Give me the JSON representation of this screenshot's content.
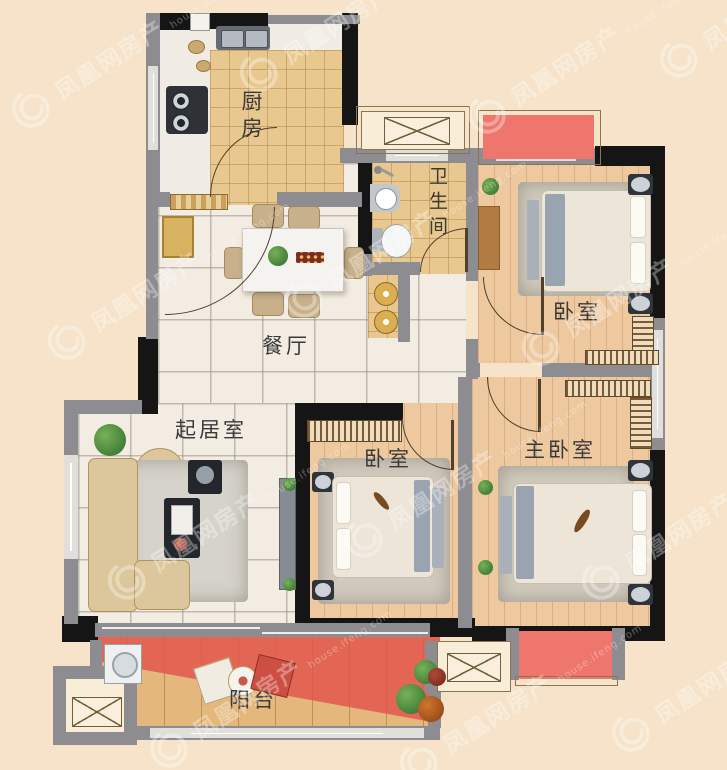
{
  "rooms": {
    "kitchen": {
      "label": "厨房"
    },
    "bathroom": {
      "label": "卫生间"
    },
    "bedroom_top": {
      "label": "卧室"
    },
    "dining": {
      "label": "餐厅"
    },
    "living": {
      "label": "起居室"
    },
    "bedroom_middle": {
      "label": "卧室"
    },
    "master": {
      "label": "主卧室"
    },
    "balcony": {
      "label": "阳台"
    }
  },
  "watermark": {
    "title": "凤凰网房产",
    "subtitle": "house.ifeng.com"
  },
  "colors": {
    "background": "#f6e3c9",
    "wall_dark": "#151515",
    "wall_gray": "#8c8c91",
    "floor_marble": "#f3ece2",
    "floor_tile": "#e9c88f",
    "floor_wood": "#eec9a0",
    "balcony_deck": "#e4b77c",
    "balcony_highlight": "#e2544a",
    "platform_red": "#ee766d",
    "watermark": "#ffffff"
  }
}
